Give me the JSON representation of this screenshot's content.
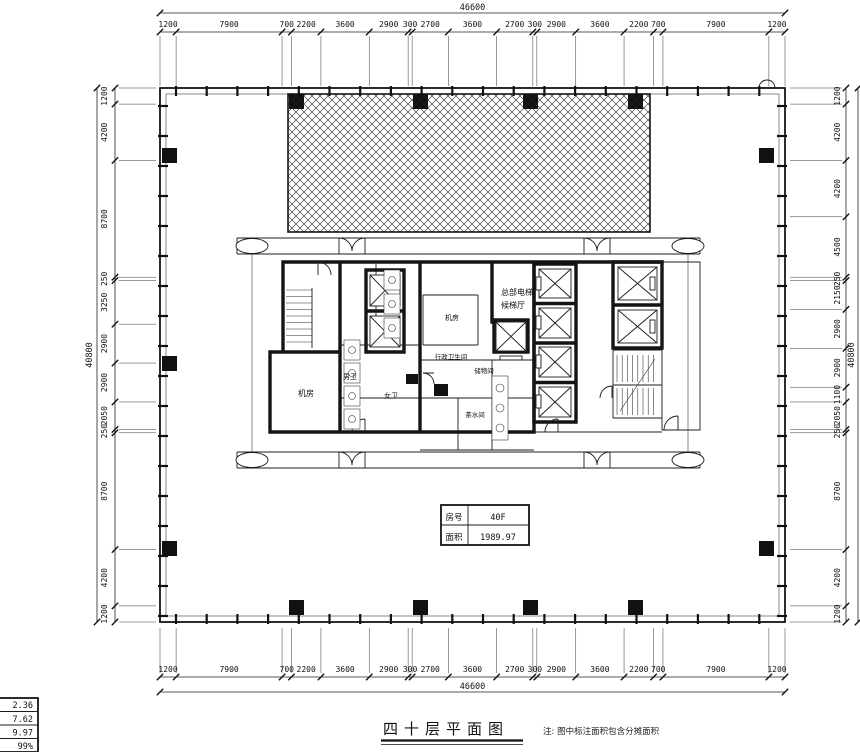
{
  "page": {
    "background": "#ffffff",
    "line_color": "#141414"
  },
  "title_block": {
    "title": "四十层平面图",
    "note": "注: 图中标注面积包含分摊面积"
  },
  "room_info_table": {
    "rows": [
      {
        "label": "房号",
        "value": "40F"
      },
      {
        "label": "面积",
        "value": "1989.97"
      }
    ]
  },
  "corner_table": {
    "rows": [
      "2.36",
      "7.62",
      "9.97",
      "99%"
    ]
  },
  "room_labels": {
    "hq_lobby_line1": "总部电梯",
    "hq_lobby_line2": "候梯厅",
    "machine_room_a": "机房",
    "machine_room_b": "机房",
    "mens_wc": "男卫",
    "womens_wc": "女卫",
    "exec_wc": "行政卫生间",
    "storage": "储物间",
    "tea_room": "茶水间"
  },
  "dimensions": {
    "top": {
      "total": "46600",
      "segments": [
        "1200",
        "7900",
        "700",
        "2200",
        "3600",
        "2900",
        "300",
        "2700",
        "3600",
        "2700",
        "300",
        "2900",
        "3600",
        "2200",
        "700",
        "7900",
        "1200"
      ]
    },
    "bottom": {
      "total": "46600",
      "segments": [
        "1200",
        "7900",
        "700",
        "2200",
        "3600",
        "2900",
        "300",
        "2700",
        "3600",
        "2700",
        "300",
        "2900",
        "3600",
        "2200",
        "700",
        "7900",
        "1200"
      ]
    },
    "left": {
      "total": "40800",
      "segments": [
        "1200",
        "4200",
        "8700",
        "250",
        "3250",
        "2900",
        "2900",
        "2050",
        "250",
        "8700",
        "4200",
        "1200"
      ]
    },
    "right": {
      "total": "40800",
      "segments": [
        "1200",
        "4200",
        "4200",
        "4500",
        "250",
        "2150",
        "2900",
        "2900",
        "1100",
        "2050",
        "250",
        "8700",
        "4200",
        "1200"
      ]
    }
  }
}
